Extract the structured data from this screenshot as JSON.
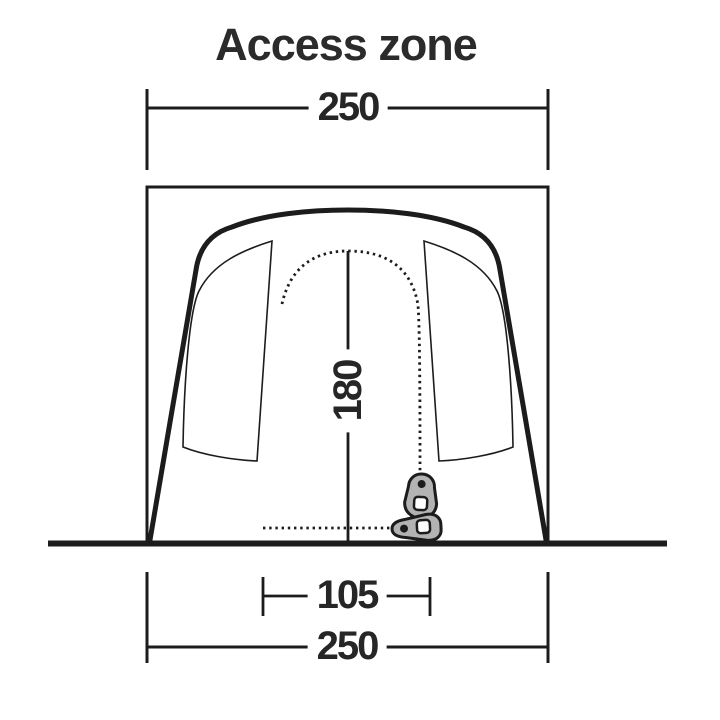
{
  "diagram": {
    "title": "Access zone",
    "dimensions": {
      "top_width": "250",
      "height": "180",
      "door_width": "105",
      "bottom_width": "250"
    },
    "colors": {
      "line": "#1c1c1c",
      "text": "#262626",
      "title_text": "#2b2b2b",
      "zipper_pull_fill": "#b3b3b3",
      "background": "#ffffff"
    },
    "icons": {
      "vertical_pull": "zipper-pull-icon",
      "horizontal_pull": "zipper-pull-icon"
    }
  }
}
